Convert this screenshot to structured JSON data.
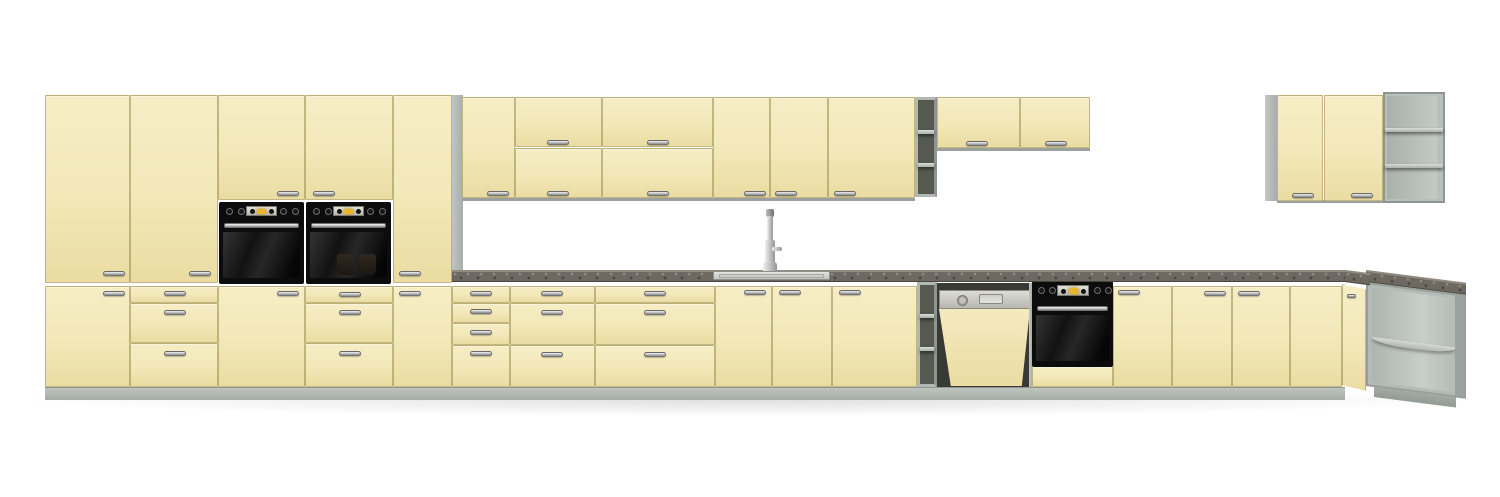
{
  "scene": {
    "type": "3D product render",
    "subject": "Cream kitchen cabinet set with built-in appliances",
    "background_color": "#ffffff"
  },
  "palette": {
    "door_cream": "#f2e8b8",
    "door_gap_line": "#998a4d",
    "carcass_gray": "#b2b9b5",
    "open_interior_dark": "#55594f",
    "plinth_gray": "#aeb4ae",
    "countertop_gray_brown": "#6d6861",
    "appliance_black": "#0c0c0c",
    "stainless_steel": "#d6d6d1",
    "oven_display_amber": "#e9b82a",
    "faucet_chrome": "#d9d9d9"
  },
  "inventory": {
    "tall_cabinets": 5,
    "built_in_wall_ovens": 2,
    "wall_cabinets": 10,
    "open_shelf_units": 4,
    "base_cabinet_sections": 12,
    "drawer_fronts": 13,
    "dishwashers": 1,
    "built_in_base_ovens": 1,
    "sinks": 1,
    "faucets": 1
  }
}
